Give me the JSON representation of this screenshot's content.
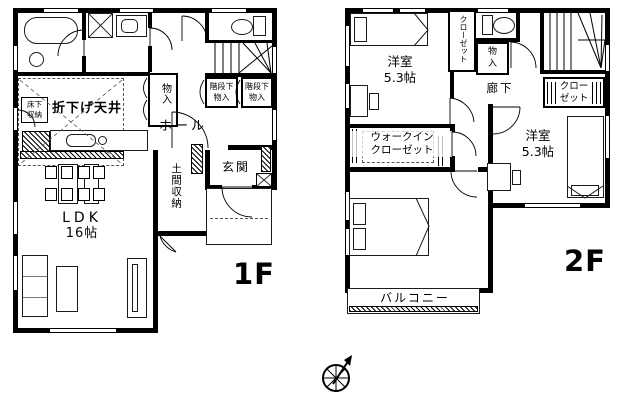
{
  "f1": {
    "floor": "1F",
    "ldk1": "LDK",
    "ldk2": "16帖",
    "orisage": "折下げ天井",
    "yukashita1": "床下",
    "yukashita2": "収納",
    "monoire": "物入",
    "kaidan1a": "階段下",
    "kaidan1b": "物入",
    "kaidan2a": "階段下",
    "kaidan2b": "物入",
    "hall": "ホール",
    "genkan": "玄関",
    "doma": "土間収納"
  },
  "f2": {
    "floor": "2F",
    "room_tl1": "洋室",
    "room_tl2": "5.3帖",
    "room_r1": "洋室",
    "room_r2": "5.3帖",
    "room_b1": "洋室",
    "room_b2": "7.8帖",
    "closet_top": "クローゼット",
    "closet_r1": "クロー",
    "closet_r2": "ゼット",
    "monoire1": "物",
    "monoire2": "入",
    "rouka": "廊下",
    "wic1": "ウォークイン",
    "wic2": "クローゼット",
    "balcony": "バルコニー"
  },
  "colors": {
    "wall": "#000000",
    "paper": "#ffffff"
  }
}
